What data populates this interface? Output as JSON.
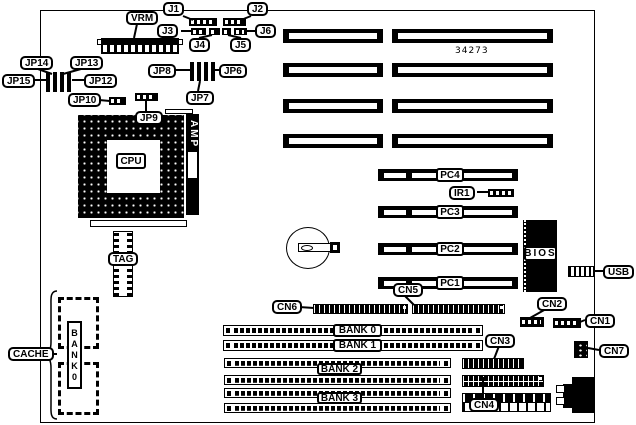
{
  "board": {
    "part_number": "34273"
  },
  "colors": {
    "line": "#000000",
    "background": "#ffffff"
  },
  "top_connectors": {
    "vrm": "VRM",
    "j1": "J1",
    "j2": "J2",
    "j3": "J3",
    "j4": "J4",
    "j5": "J5",
    "j6": "J6"
  },
  "jumpers": {
    "jp14": "JP14",
    "jp13": "JP13",
    "jp15": "JP15",
    "jp12": "JP12",
    "jp10": "JP10",
    "jp9": "JP9",
    "jp8": "JP8",
    "jp6": "JP6",
    "jp7": "JP7"
  },
  "cpu_area": {
    "cpu": "CPU",
    "amp": "AMP",
    "tag": "TAG"
  },
  "cache_area": {
    "cache": "CACHE",
    "bank_chip_label": "BANK0"
  },
  "memory_banks": {
    "bank0": "BANK 0",
    "bank1": "BANK 1",
    "bank2": "BANK 2",
    "bank3": "BANK 3"
  },
  "pci_slots": {
    "pc1": "PC1",
    "pc2": "PC2",
    "pc3": "PC3",
    "pc4": "PC4"
  },
  "onboard": {
    "ir1": "IR1",
    "bios": "BIOS",
    "usb": "USB"
  },
  "io_connectors": {
    "cn1": "CN1",
    "cn2": "CN2",
    "cn3": "CN3",
    "cn4": "CN4",
    "cn5": "CN5",
    "cn6": "CN6",
    "cn7": "CN7"
  }
}
